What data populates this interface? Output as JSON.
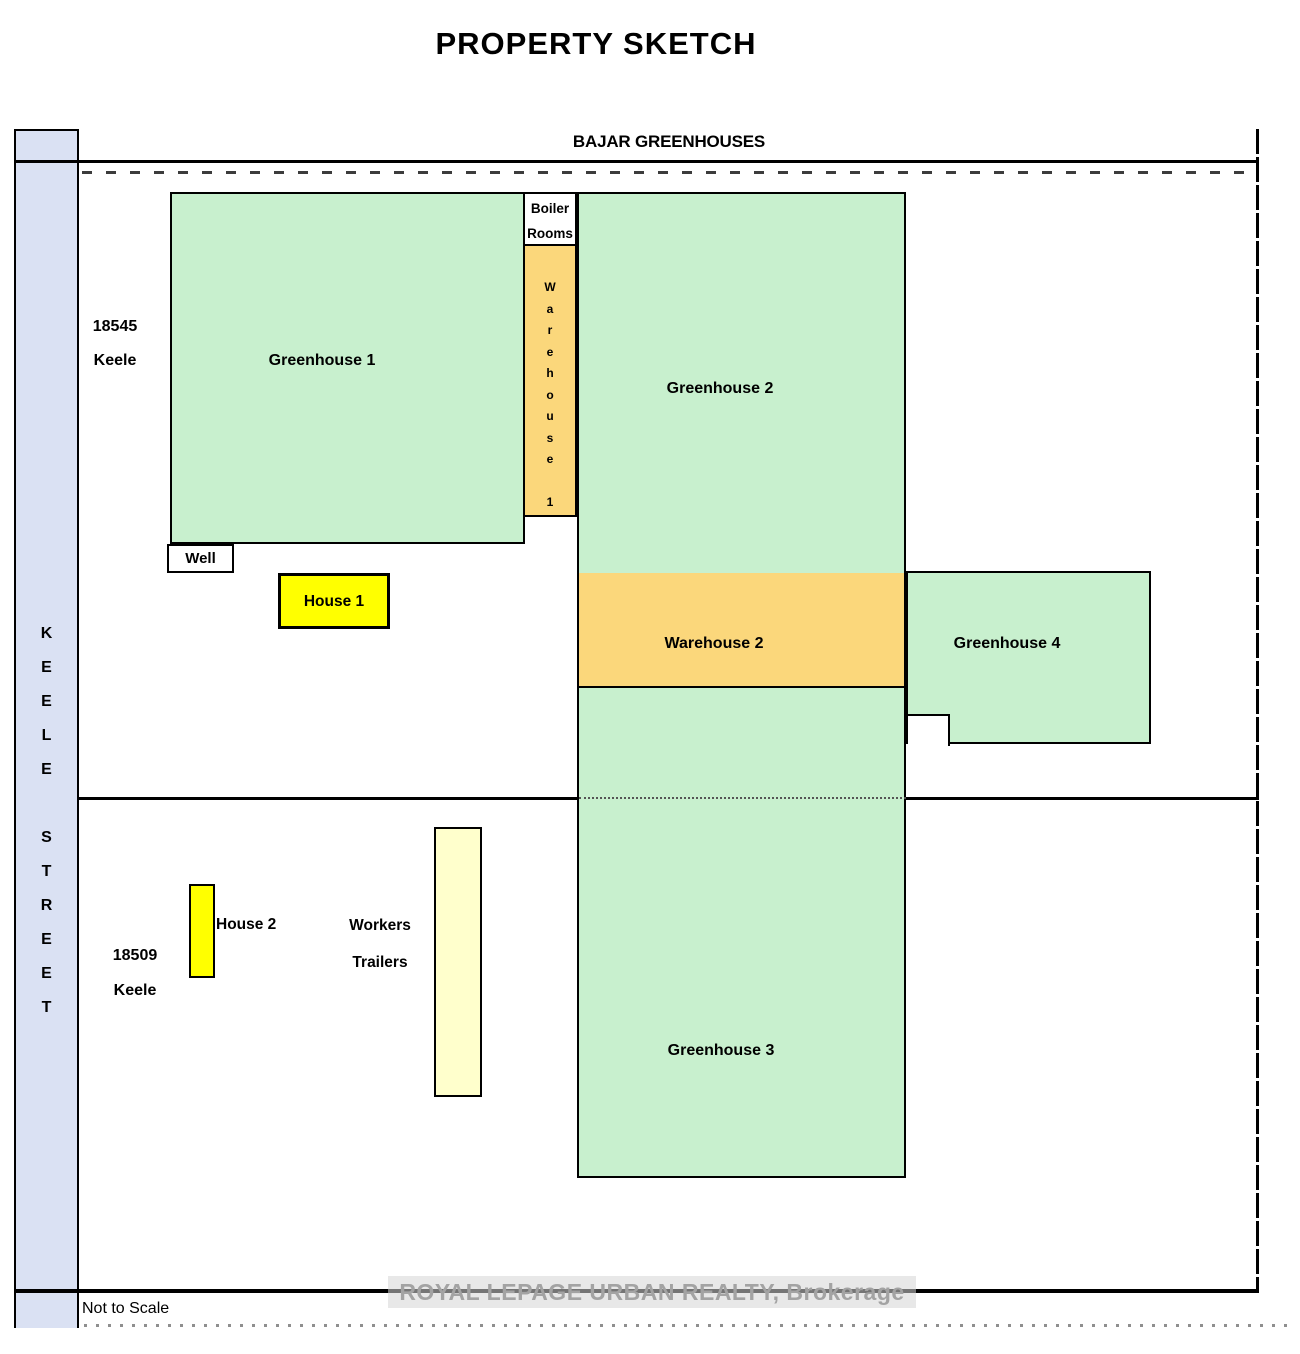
{
  "page": {
    "title": "PROPERTY SKETCH",
    "site_label": "BAJAR GREENHOUSES",
    "not_to_scale": "Not to Scale",
    "watermark": "ROYAL LEPAGE URBAN REALTY, Brokerage"
  },
  "street": {
    "name": "KEELE STREET"
  },
  "addresses": {
    "north": "18545\nKeele",
    "south": "18509\nKeele"
  },
  "buildings": {
    "greenhouse1": {
      "label": "Greenhouse 1"
    },
    "greenhouse2": {
      "label": "Greenhouse 2"
    },
    "greenhouse3": {
      "label": "Greenhouse 3"
    },
    "greenhouse4": {
      "label": "Greenhouse 4"
    },
    "warehouse1": {
      "label": "Warehouse 1"
    },
    "warehouse2": {
      "label": "Warehouse 2"
    },
    "boiler_rooms": {
      "label": "Boiler\nRooms"
    },
    "well": {
      "label": "Well"
    },
    "house1": {
      "label": "House 1"
    },
    "house2": {
      "label": "House 2"
    },
    "workers_trailers": {
      "label": "Workers\nTrailers"
    }
  },
  "colors": {
    "greenhouse_fill": "#c8f0ce",
    "warehouse_fill": "#fbd77b",
    "house_fill": "#ffff00",
    "trailer_fill": "#ffffcc",
    "street_band_fill": "#dae1f3",
    "boundary": "#000000"
  }
}
